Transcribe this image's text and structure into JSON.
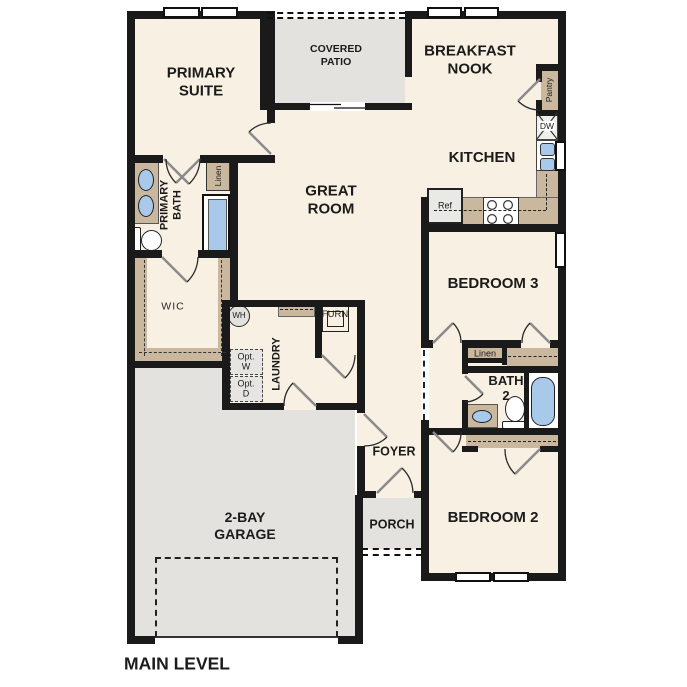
{
  "title": "MAIN LEVEL",
  "rooms": {
    "primary_suite": "PRIMARY\nSUITE",
    "covered_patio": "COVERED\nPATIO",
    "breakfast_nook": "BREAKFAST\nNOOK",
    "kitchen": "KITCHEN",
    "great_room": "GREAT\nROOM",
    "primary_bath": "PRIMARY\nBATH",
    "wic": "WIC",
    "laundry": "LAUNDRY",
    "foyer": "FOYER",
    "porch": "PORCH",
    "garage": "2-BAY\nGARAGE",
    "bedroom3": "BEDROOM 3",
    "bath2": "BATH\n2",
    "bedroom2": "BEDROOM 2"
  },
  "fixtures": {
    "water_heater": "WH",
    "furnace": "FURN",
    "washer_optional": "Opt.\nW",
    "dryer_optional": "Opt.\nD",
    "refrigerator": "Ref",
    "dishwasher": "DW",
    "pantry": "Pantry",
    "linen_primary": "Linen",
    "linen_hall": "Linen"
  },
  "colors": {
    "wall": "#1a1a1a",
    "floor": "#f8f0e2",
    "outdoor": "#e3e2df",
    "cabinet": "#c9b89e",
    "plumbing_blue": "#a9c9eb"
  }
}
